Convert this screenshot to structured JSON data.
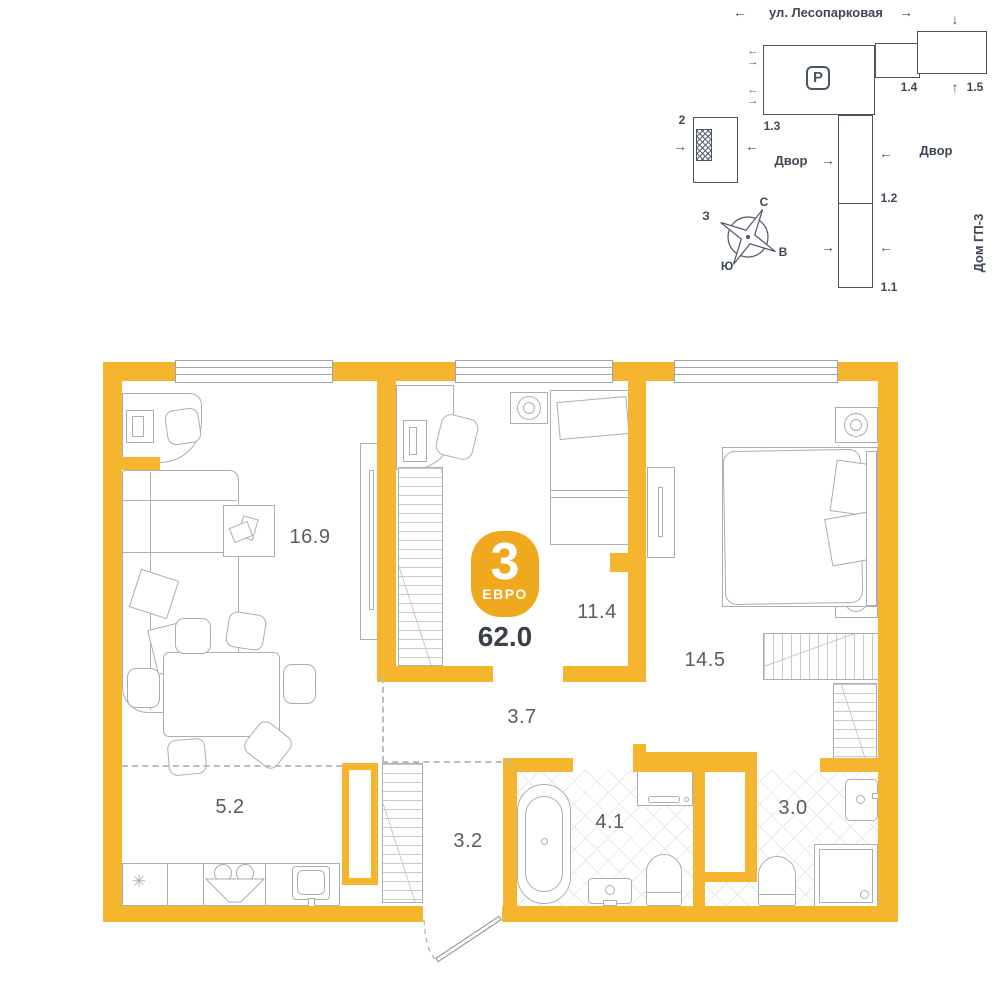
{
  "site_plan": {
    "street": "ул. Лесопарковая",
    "courtyard_left": "Двор",
    "courtyard_right": "Двор",
    "house_name": "Дом ГП-3",
    "parking": "P",
    "buildings": {
      "b2": "2",
      "b13": "1.3",
      "b14": "1.4",
      "b15": "1.5",
      "b12": "1.2",
      "b11": "1.1"
    },
    "compass": {
      "n": "С",
      "e": "В",
      "s": "Ю",
      "w": "З"
    }
  },
  "plan": {
    "badge": {
      "rooms_count": "3",
      "type": "ЕВРО",
      "total_area": "62.0"
    },
    "rooms": [
      {
        "id": "living",
        "area": "16.9"
      },
      {
        "id": "bedroom2",
        "area": "11.4"
      },
      {
        "id": "bedroom1",
        "area": "14.5"
      },
      {
        "id": "hallway",
        "area": "3.7"
      },
      {
        "id": "kitchen",
        "area": "5.2"
      },
      {
        "id": "entry",
        "area": "3.2"
      },
      {
        "id": "bathroom",
        "area": "4.1"
      },
      {
        "id": "wc",
        "area": "3.0"
      }
    ]
  },
  "icons": {
    "fridge": "✳",
    "arrow_left": "←",
    "arrow_right": "→",
    "arrow_up": "↑",
    "arrow_down": "↓"
  },
  "colors": {
    "wall": "#F5B52F",
    "badge": "#F0A91E",
    "furniture_line": "#A9AFB6",
    "site_line": "#4A5563",
    "label_text": "#575C63",
    "total_text": "#3A4049"
  }
}
